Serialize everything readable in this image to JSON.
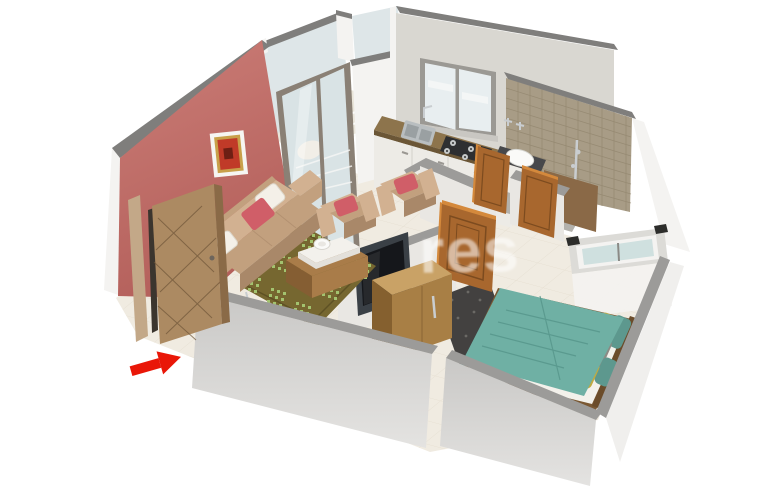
{
  "scene": {
    "description": "3D isometric rendering of a 1BHK apartment floor plan: living room with sofa set and TV, kitchen with window, bathroom with tiled wall, bedroom with teal bed, balcony with glass doors, entrance marked by a red arrow"
  },
  "watermark": {
    "text": "res"
  },
  "entrance": {
    "arrow_shape": "arrow-pointing-to-door",
    "arrow_color": "#e91708"
  },
  "palette": {
    "background": "#ffffff",
    "watermark": "rgba(255,255,255,0.55)",
    "wall_cap": "#7f7e7c",
    "wall_cap_light": "#9c9b99",
    "wall_face": "#e9e7e3",
    "wall_outer": "#c9c8c6",
    "wall_outer_bottom": "#e4e3e1",
    "wall_outer_light": "#f0efed",
    "wall_white": "#f4f3f1",
    "kitchen_wall": "#d9d7d1",
    "accent_wall": "#cb7d77",
    "accent_wall_dark": "#b4605b",
    "floor": "#f0ebe1",
    "floor_line": "#ddd5c5",
    "balcony_floor": "#e9e5da",
    "glass": "#d9e3e5",
    "glass_frame": "#8a8075",
    "window_frame": "#9b9994",
    "window_glass": "#e8eef0",
    "bedroom_window_glass": "#cfe0df",
    "window_recess": "#dcdbd7",
    "tile_wall": "#a89c86",
    "tile_line": "#91856d",
    "granite": "#8d744c",
    "granite_dark": "#6b5636",
    "cabinet_white": "#edebe6",
    "steel": "#b9bec0",
    "steel_dark": "#9aa0a2",
    "stove_dark": "#2e2f31",
    "burner": "#c7caca",
    "basin_counter": "#47484b",
    "basin_white": "#fafaf8",
    "bath_floor": "#b3b1ac",
    "bath_inner_wall": "#8a6947",
    "wood_door": "#a8672e",
    "wood_door_light": "#d4893c",
    "wood_door_dark": "#7c4b1f",
    "entrance_door": "#ac8a62",
    "entrance_door_edge": "#8a6a47",
    "entrance_frame": "#c3a888",
    "entrance_lattice": "#6e5538",
    "rug_olive": "#766730",
    "rug_border": "#5e5124",
    "rug_dot": "#a3c36f",
    "sofa": "#c2a07e",
    "sofa_light": "#d2b191",
    "sofa_dark": "#a98869",
    "cushion_red": "#d05e68",
    "pillow_white": "#f4f0e8",
    "table_wood": "#a97c49",
    "table_wood_dark": "#855e33",
    "table_white": "#f3f1ec",
    "tv_frame": "#3a4046",
    "tv_screen": "#15171b",
    "dresser_top": "#c9a266",
    "dresser_front": "#a87f45",
    "dresser_side": "#85602f",
    "bed_frame": "#7a5833",
    "headboard": "#6b4c2a",
    "mattress": "#f3f1eb",
    "duvet": "#6fb0a4",
    "duvet_dark": "#56958a",
    "pillow_yellow": "#c0aa41",
    "pillow_gray": "#8c8a84",
    "pillow_teal": "#5d988e",
    "shag": "#434140",
    "shag_spec": "#6b6965",
    "arrow_red": "#e91708",
    "chrome": "#c9cdd0",
    "picture_frame": "#f6f5f2",
    "picture_gold": "#c8a04a",
    "picture_art": "#c03a28"
  }
}
